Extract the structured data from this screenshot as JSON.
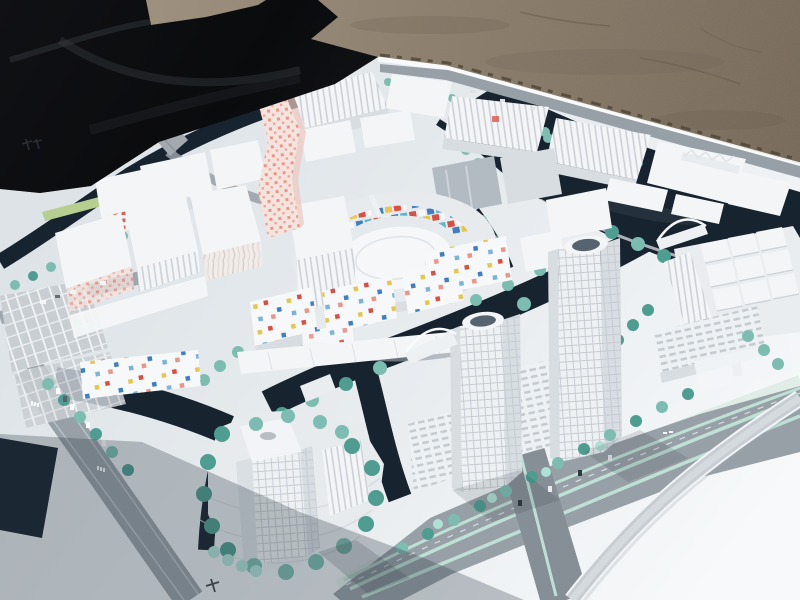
{
  "scene": {
    "subject": "Architectural scale model of a waterfront city district photographed outdoors",
    "environment": {
      "ground": "gravel-sand",
      "covering": "black-tarp-upper-left",
      "base": "white-foamboard-model-base"
    },
    "model_features": [
      "pink-dotted-twisted-tower",
      "circular-mosaic-plaza-ring",
      "twin-grid-facade-towers",
      "island-tower",
      "canal-network",
      "teal-model-trees",
      "boulevard-with-teal-medians",
      "curved-ramp-road",
      "arch-bridges",
      "confetti-facade-buildings",
      "ribbed-warehouse-blocks",
      "parking-lots",
      "cube-building-cluster"
    ],
    "marks": [
      {
        "name": "maker-stamp-left-board",
        "legible": false
      },
      {
        "name": "road-glyph-bottom",
        "legible": false
      },
      {
        "name": "road-label-left-1",
        "legible": false
      },
      {
        "name": "road-label-left-2",
        "legible": false
      }
    ]
  },
  "palette": {
    "sand": "#9c8d79",
    "sand2": "#756858",
    "tarp": "#0c0d10",
    "tarp2": "#2a2d33",
    "board": "#e3e8ec",
    "board2": "#f7f9fa",
    "water": "#182330",
    "water2": "#10181f",
    "road": "#98a0a7",
    "road2": "#7f878e",
    "median": "#bfe0d5",
    "tree": "#7cbcb1",
    "tree2": "#4f9c91",
    "tree3": "#aee0d6",
    "lawn": "#b6cf90",
    "bface": "#f3f5f7",
    "bside": "#d8dde2",
    "bshade": "#c4cbd1",
    "mirror": "#b2bac2",
    "grid": "#c7ccd3",
    "gridbg": "#eef1f3",
    "pink": "#f5e3de",
    "pinkdot": "#e9968a",
    "red": "#d84f43",
    "blue": "#3f7fc0",
    "yellow": "#e7c64f",
    "sky": "#7db3d6",
    "tealtile": "#5fb6c7",
    "rooftop": "#56626d",
    "shadow": "#25313c",
    "white": "#fafbfc"
  }
}
